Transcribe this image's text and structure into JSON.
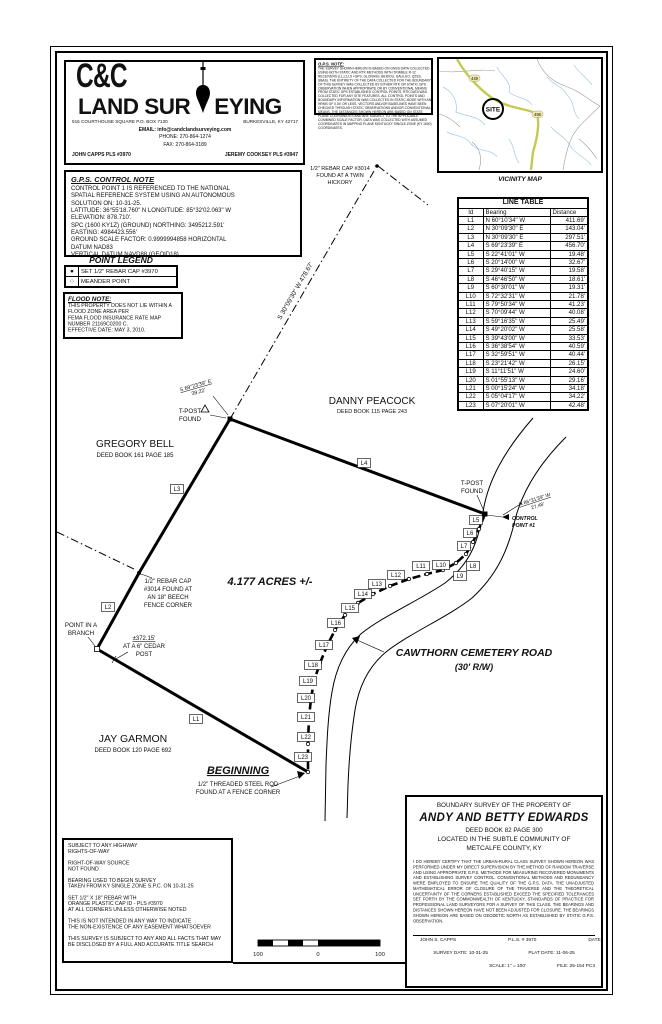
{
  "header": {
    "company_line1": "C&C",
    "company_word_a": "LAND SUR",
    "company_word_b": "EYING",
    "address_left": "516 COURTHOUSE SQUARE  P.O. BOX 7130",
    "address_right": "BURKESVILLE, KY 42717",
    "email": "EMAIL: info@candclandsurveying.com",
    "phone": "PHONE:  270-864-1274",
    "fax": "FAX:  270-864-3189",
    "surveyor_left": "JOHN CAPPS PLS #3970",
    "surveyor_right": "JEREMY COOKSEY PLS #3947"
  },
  "gps_note": {
    "title": "G.P.S. NOTE:",
    "body": "THE SURVEY SHOWN HEREON IS BASED ON GNSS DATA COLLECTED USING BOTH STATIC AND RTK METHODS WITH TRIMBLE R-12 RECEIVERS (L1,L2,L5 +GPS, GLONASS, BEIDOU, GALILEO, QZSS, SBAS). THE ENTIRETY OF THE DATA COLLECTED FOR THE BOUNDARY OF THIS SURVEY WAS COLLECTED BY EITHER RTK OR STATIC GPS OBSERVATION WHEN APPROPRIATE OR BY CONVENTIONAL MEANS FROM STATIC GPS ESTABLISHED CONTROL POINTS. RTK DATA WAS COLLECTED FOR ANY SITE FEATURES. ALL CONTROL POINTS AND BOUNDARY INFORMATION WAS COLLECTED IN STATIC MODE WITH AN HRMS OF 0.04' OR LESS. VECTORS AND/OR BASELINES HAVE BEEN CHECKED THROUGH STATIC OBSERVATIONS AND/OR CONVENTIONAL MEANS. THE DISTANCES SHOWN HEREON ARE BASED ON STATE PLANE COORDINATES AND ARE SUBJECT TO THE APPLICABLE COMBINED SCALE FACTOR. DATA WAS COLLECTED WITH ASSUMED COORDINATES IN MAPPING PLANE KENTUCKY SINGLE ZONE (KY 1600) COORDINATES."
  },
  "vicinity_map": {
    "caption": "VICINITY MAP",
    "site_label": "SITE",
    "route_labels": [
      "449",
      "496"
    ],
    "highway_color": "#c2ca52",
    "stream_color": "#a9c7e6",
    "road_color": "#9a9a9a"
  },
  "gps_control_note": {
    "title": "G.P.S. CONTROL NOTE",
    "body": "CONTROL POINT 1 IS REFERENCED TO THE NATIONAL\nSPATIAL REFERENCE SYSTEM USING AN AUTONOMOUS\nSOLUTION ON: 10-31-25.\nLATITUDE: 36°55'18.760\" N  LONGITUDE: 85°32'02.063\" W\nELEVATION: 878.710'.\nSPC (1600 KY1Z) (GROUND) NORTHING: 3495212.591'\nEASTING: 4984423.556'\nGROUND SCALE FACTOR: 0.9999994858   HORIZONTAL\nDATUM NAD83\nVERTICAL DATUM NAVD88 (GEOID18)."
  },
  "point_legend": {
    "title": "POINT LEGEND",
    "items": [
      {
        "symbol": "filled-circle",
        "label": "SET 1/2\" REBAR CAP #3970"
      },
      {
        "symbol": "open-circle",
        "label": "MEANDER POINT"
      }
    ]
  },
  "flood_note": {
    "title": "FLOOD NOTE:",
    "body": "THIS PROPERTY DOES NOT LIE WITHIN A\nFLOOD ZONE AREA PER\nFEMA FLOOD INSURANCE RATE MAP\nNUMBER 21169C0200 C.\nEFFECTIVE DATE: MAY 3, 2010."
  },
  "line_table": {
    "title": "LINE TABLE",
    "columns": [
      "Id",
      "Bearing",
      "Distance"
    ],
    "rows": [
      [
        "L1",
        "N 60°10'34\" W",
        "411.69'"
      ],
      [
        "L2",
        "N 30°09'30\" E",
        "143.04'"
      ],
      [
        "L3",
        "N 30°09'30\" E",
        "297.51'"
      ],
      [
        "L4",
        "S 69°23'39\" E",
        "456.70'"
      ],
      [
        "L5",
        "S 22°41'01\" W",
        "19.48'"
      ],
      [
        "L6",
        "S 20°14'00\" W",
        "32.67'"
      ],
      [
        "L7",
        "S 29°40'15\" W",
        "19.58'"
      ],
      [
        "L8",
        "S 46°46'50\" W",
        "18.61'"
      ],
      [
        "L9",
        "S 60°30'01\" W",
        "19.31'"
      ],
      [
        "L10",
        "S 72°32'31\" W",
        "21.78'"
      ],
      [
        "L11",
        "S 79°50'34\" W",
        "41.23'"
      ],
      [
        "L12",
        "S 70°09'44\" W",
        "40.08'"
      ],
      [
        "L13",
        "S 59°16'35\" W",
        "25.49'"
      ],
      [
        "L14",
        "S 49°20'02\" W",
        "25.58'"
      ],
      [
        "L15",
        "S 39°43'00\" W",
        "33.53'"
      ],
      [
        "L16",
        "S 36°38'54\" W",
        "40.59'"
      ],
      [
        "L17",
        "S 32°59'51\" W",
        "40.44'"
      ],
      [
        "L18",
        "S 23°21'42\" W",
        "26.15'"
      ],
      [
        "L19",
        "S 11°11'51\" W",
        "24.60'"
      ],
      [
        "L20",
        "S 01°55'13\" W",
        "29.16'"
      ],
      [
        "L21",
        "S 00°15'24\" W",
        "34.18'"
      ],
      [
        "L22",
        "S 05°04'17\" W",
        "34.22'"
      ],
      [
        "L23",
        "S 07°20'01\" W",
        "42.48'"
      ]
    ]
  },
  "drawing": {
    "acreage": "4.177 ACRES +/-",
    "road_name": "CAWTHORN CEMETERY ROAD",
    "road_rw": "(30' R/W)",
    "adjoiners": {
      "gregory_name": "GREGORY BELL",
      "gregory_deed": "DEED BOOK 161 PAGE 185",
      "danny_name": "DANNY PEACOCK",
      "danny_deed": "DEED BOOK 115 PAGE 243",
      "jay_name": "JAY GARMON",
      "jay_deed": "DEED BOOK 120 PAGE 692"
    },
    "labels": {
      "hickory1": "1/2\" REBAR CAP #3014",
      "hickory2": "FOUND AT A TWIN",
      "hickory3": "HICKORY",
      "tie_bearing": "S 30°09'30\" W    478.67'",
      "tpost1a": "T-POST",
      "tpost1b": "FOUND",
      "tpost2a": "T-POST",
      "tpost2b": "FOUND",
      "corner_tie_b": "S 69°23'39\" E",
      "corner_tie_d": "39.22'",
      "cp_tie_b": "N 86°31'39\" W",
      "cp_tie_d": "27.48'",
      "cp1": "CONTROL",
      "cp2": "POINT #1",
      "beech1": "1/2\" REBAR CAP",
      "beech2": "#3014 FOUND AT",
      "beech3": "AN 18\" BEECH",
      "beech4": "FENCE CORNER",
      "branch1": "POINT IN A",
      "branch2": "BRANCH",
      "cedar1": "±372.15'",
      "cedar2": "AT A 6\" CEDAR",
      "cedar3": "POST",
      "beginning": "BEGINNING",
      "beg_note1": "1/2\" THREADED STEEL ROD",
      "beg_note2": "FOUND AT A FENCE CORNER"
    },
    "line_markers": [
      {
        "t": "L1",
        "x": 196,
        "y": 719
      },
      {
        "t": "L2",
        "x": 108,
        "y": 607
      },
      {
        "t": "L3",
        "x": 177,
        "y": 489
      },
      {
        "t": "L4",
        "x": 364,
        "y": 463
      },
      {
        "t": "L5",
        "x": 476,
        "y": 520
      },
      {
        "t": "L6",
        "x": 470,
        "y": 533
      },
      {
        "t": "L7",
        "x": 464,
        "y": 546
      },
      {
        "t": "L8",
        "x": 473,
        "y": 566
      },
      {
        "t": "L9",
        "x": 460,
        "y": 576
      },
      {
        "t": "L10",
        "x": 441,
        "y": 565
      },
      {
        "t": "L11",
        "x": 421,
        "y": 566
      },
      {
        "t": "L12",
        "x": 396,
        "y": 575
      },
      {
        "t": "L13",
        "x": 377,
        "y": 584
      },
      {
        "t": "L14",
        "x": 363,
        "y": 594
      },
      {
        "t": "L15",
        "x": 350,
        "y": 608
      },
      {
        "t": "L16",
        "x": 336,
        "y": 623
      },
      {
        "t": "L17",
        "x": 324,
        "y": 645
      },
      {
        "t": "L18",
        "x": 313,
        "y": 665
      },
      {
        "t": "L19",
        "x": 308,
        "y": 681
      },
      {
        "t": "L20",
        "x": 306,
        "y": 698
      },
      {
        "t": "L21",
        "x": 306,
        "y": 717
      },
      {
        "t": "L22",
        "x": 306,
        "y": 737
      },
      {
        "t": "L23",
        "x": 303,
        "y": 757
      }
    ]
  },
  "scale_bar": {
    "left": "100",
    "zero": "0",
    "right": "100"
  },
  "title_block": {
    "header": "BOUNDARY SURVEY OF THE PROPERTY OF",
    "owner": "ANDY AND BETTY EDWARDS",
    "deed": "DEED BOOK 82 PAGE 300",
    "located1": "LOCATED IN THE SUBTLE COMMUNITY OF",
    "located2": "METCALFE COUNTY, KY",
    "certification": "I DO HEREBY CERTIFY THAT THE URBAN-RURAL CLASS SURVEY SHOWN HEREON WAS PERFORMED UNDER MY DIRECT SUPERVISION BY THE METHOD OF RANDOM TRAVERSE AND USING APPROPRIATE G.P.S. METHODS FOR MEASURING RECOVERED MONUMENTS AND ESTABLISHING SURVEY CONTROL.  CONVENTIONAL METHODS AND REDUNDANCY WERE EMPLOYED TO ENSURE THE QUALITY OF THE G.P.S. DATA.  THE UNADJUSTED MATHEMATICAL ERROR OF CLOSURE OF THE TRAVERSE AND THE THEORETICAL UNCERTAINTY OF THE CORNERS ESTABLISHED EXCEED THE SPECIFIED TOLERANCES SET FORTH BY THE COMMONWEALTH OF KENTUCKY, STANDARDS OF PRACTICE FOR PROFESSIONAL LAND SURVEYORS FOR A SURVEY OF THIS CLASS.  THE BEARINGS AND DISTANCES SHOWN HEREON HAVE NOT BEEN ADJUSTED FOR CLOSURE.  THE BEARINGS SHOWN HEREON ARE BASED ON GEODETIC NORTH AS ESTABLISHED BY STATIC G.P.S. OBSERVATION.",
    "signer_name": "JOHN  S.  CAPPS",
    "signer_pls": "P.L.S.  #  3970",
    "date_label": "DATE:",
    "survey_date": "SURVEY DATE:  10-31-25",
    "plat_date": "PLAT DATE:  11-06-25",
    "scale": "SCALE:  1\" = 100'",
    "file": "FILE: 25-154 PC3"
  },
  "notes": {
    "body": "SUBJECT TO ANY HIGHWAY\nRIGHTS-OF-WAY\n\nRIGHT-OF-WAY SOURCE\nNOT FOUND\n\nBEARING USED TO BEGIN SURVEY\nTAKEN FROM KY SINGLE ZONE S.P.C. ON 10-31-25\n\nSET 1/2\" X 18\" REBAR WITH\nORANGE PLASTIC CAP ID - PLS #3970\nAT ALL CORNERS UNLESS OTHERWISE NOTED\n\nTHIS IS NOT INTENDED IN ANY WAY TO INDICATE\nTHE NON-EXISTENCE OF ANY EASEMENT WHATSOEVER\n\nTHIS SURVEY IS SUBJECT TO ANY AND ALL FACTS THAT MAY\nBE DISCLOSED BY A FULL AND ACCURATE TITLE SEARCH"
  }
}
